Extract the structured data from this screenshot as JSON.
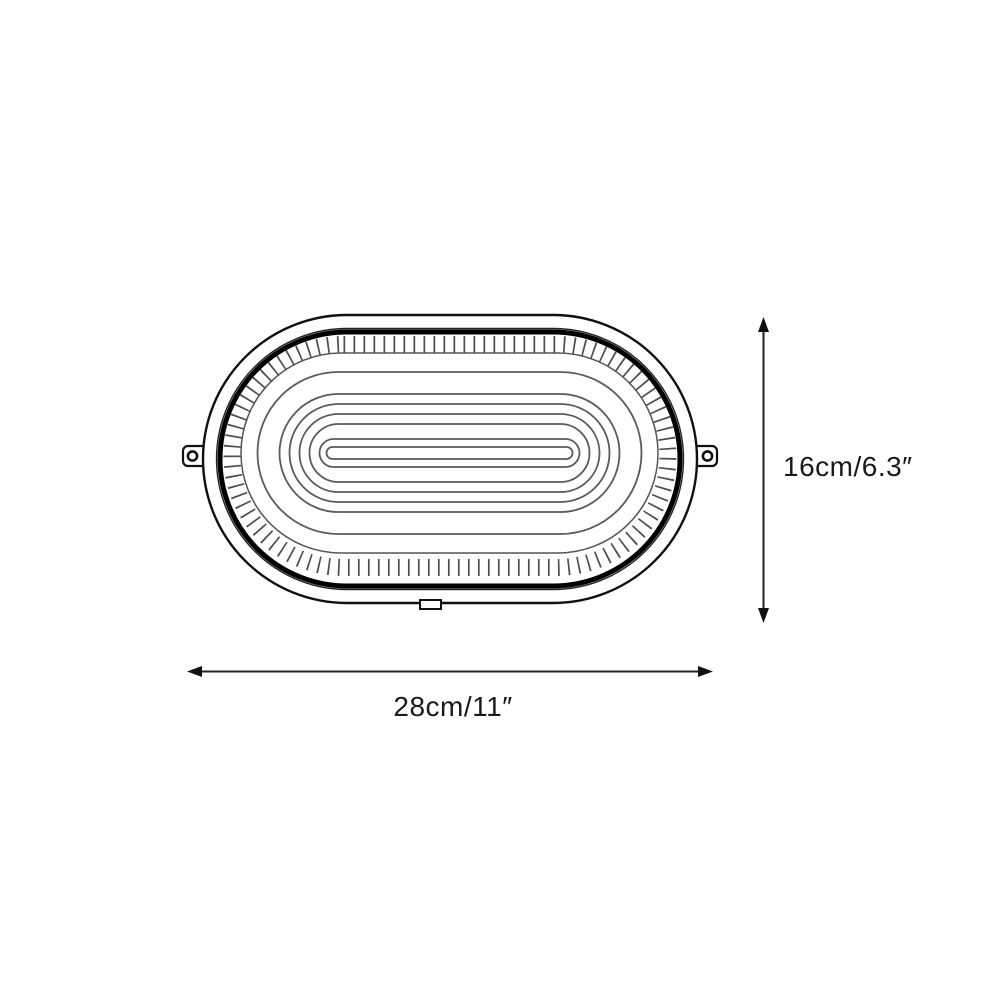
{
  "diagram": {
    "type": "product-dimension-diagram",
    "subject": "oval bulkhead lamp technical line drawing",
    "line_color": "#111111",
    "ring_color": "#5a5a5a",
    "background_color": "#ffffff",
    "dimensions": {
      "height": {
        "label": "16cm/6.3″",
        "orientation": "vertical"
      },
      "width": {
        "label": "28cm/11″",
        "orientation": "horizontal"
      }
    }
  }
}
